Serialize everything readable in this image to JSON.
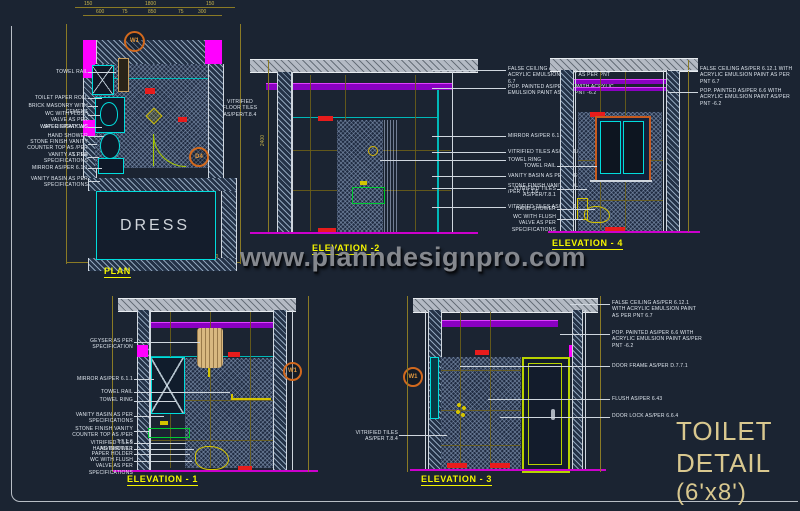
{
  "watermark": {
    "text": "www.planndesignpro.com"
  },
  "title_block": {
    "line1": "TOILET",
    "line2": "DETAIL",
    "line3": "(6'x8')"
  },
  "tags": {
    "window": "W1",
    "door": "D4"
  },
  "dims": {
    "plan_top": [
      "150",
      "1800",
      "150"
    ],
    "plan_top2": [
      "600",
      "75",
      "850",
      "75",
      "300"
    ],
    "plan_bottom": [
      "150",
      "1800",
      "150"
    ],
    "wall_height": "2400"
  },
  "views": {
    "plan": {
      "title": "PLAN",
      "room": "DRESS",
      "floor_label": "VITRIFIED FLOOR TILES AS/PER/T.8.4",
      "labels_left": [
        "TOWEL RAIL",
        "TOILET PAPER ROLL",
        "BRICK MASONRY WITH CEMENT",
        "WC WITH FLUSH VALVE AS PER SPECIFICATIONS",
        "WATER SPRAY WC",
        "HAND SHOWER",
        "STONE FINISH VANITY COUNTER TOP AS /PER T.7.1.6",
        "VANITY AS PER SPECIFICATIONS",
        "MIRROR AS/PER 6.1.1",
        "VANITY BASIN AS PER SPECIFICATIONS"
      ]
    },
    "elevation_2": {
      "title": "ELEVATION -2",
      "labels_right": [
        "FALSE CEILING AS/PER 6.12.1 WITH ACRYLIC EMULSION PAINT AS PER PNT 6.7",
        "POP. PAINTED AS/PER 6.6 WITH ACRYLIC EMULSION PAINT AS/PER PNT -6.2",
        "MIRROR AS/PER 6.1.1",
        "VITRIFIED TILES AS/PER/T.8.1",
        "TOWEL RING",
        "VANITY BASIN AS PER SPECIFICATIONS",
        "STONE FINISH VANITY COUNTER TOP AS /PER T.7.1.6",
        "VITRIFIED TILES AS/PER/T.8.4"
      ]
    },
    "elevation_4": {
      "title": "ELEVATION - 4",
      "labels_left": [
        "TOWEL RAIL",
        "VITRIFIED TILES AS/PER/T.8.1",
        "HAND SHOWER",
        "WC WITH FLUSH VALVE AS PER SPECIFICATIONS"
      ],
      "labels_right": [
        "FALSE CEILING AS/PER 6.12.1 WITH ACRYLIC EMULSION PAINT AS PER PNT 6.7",
        "POP. PAINTED AS/PER 6.6 WITH ACRYLIC EMULSION PAINT AS/PER PNT -6.2"
      ]
    },
    "elevation_1": {
      "title": "ELEVATION - 1",
      "labels_left": [
        "GEYSER AS PER SPECIFICATION",
        "MIRROR AS/PER 6.1.1",
        "TOWEL RAIL",
        "TOWEL RING",
        "VANITY BASIN AS PER SPECIFICATIONS",
        "STONE FINISH VANITY COUNTER TOP AS /PER T.7.1.6",
        "VITRIFIED TILES AS/PER/T.8.1",
        "HAND SHOWER",
        "PAPER HOLDER",
        "WC WITH FLUSH VALVE AS PER SPECIFICATIONS"
      ]
    },
    "elevation_3": {
      "title": "ELEVATION - 3",
      "labels_left": [
        "VITRIFIED TILES AS/PER T.8.4"
      ],
      "labels_right": [
        "FALSE CEILING AS/PER 6.12.1 WITH ACRYLIC EMULSION PAINT AS PER PNT 6.7",
        "POP. PAINTED AS/PER 6.6 WITH ACRYLIC EMULSION PAINT AS/PER PNT -6.2",
        "DOOR FRAME AS/PER D.7.7.1",
        "FLUSH AS/PER 6.43",
        "DOOR LOCK AS/PER 6.6.4"
      ]
    }
  },
  "colors": {
    "background": "#1b2432",
    "dim_line": "#8a7a25",
    "annotation": "#dfe6ee",
    "view_title": "#f5f500",
    "magenta": "#ff00ff",
    "purple_band": "#8a00c2",
    "cyan": "#00dcdc",
    "green": "#00cc33",
    "red": "#e81c1c",
    "slab_gray": "#b4bac4",
    "geyser_tan": "#d8b880",
    "door_green": "#b8d200",
    "tag_orange": "#d2691e",
    "title_text": "#d9c88f",
    "watermark_gray": "#8e9096"
  }
}
